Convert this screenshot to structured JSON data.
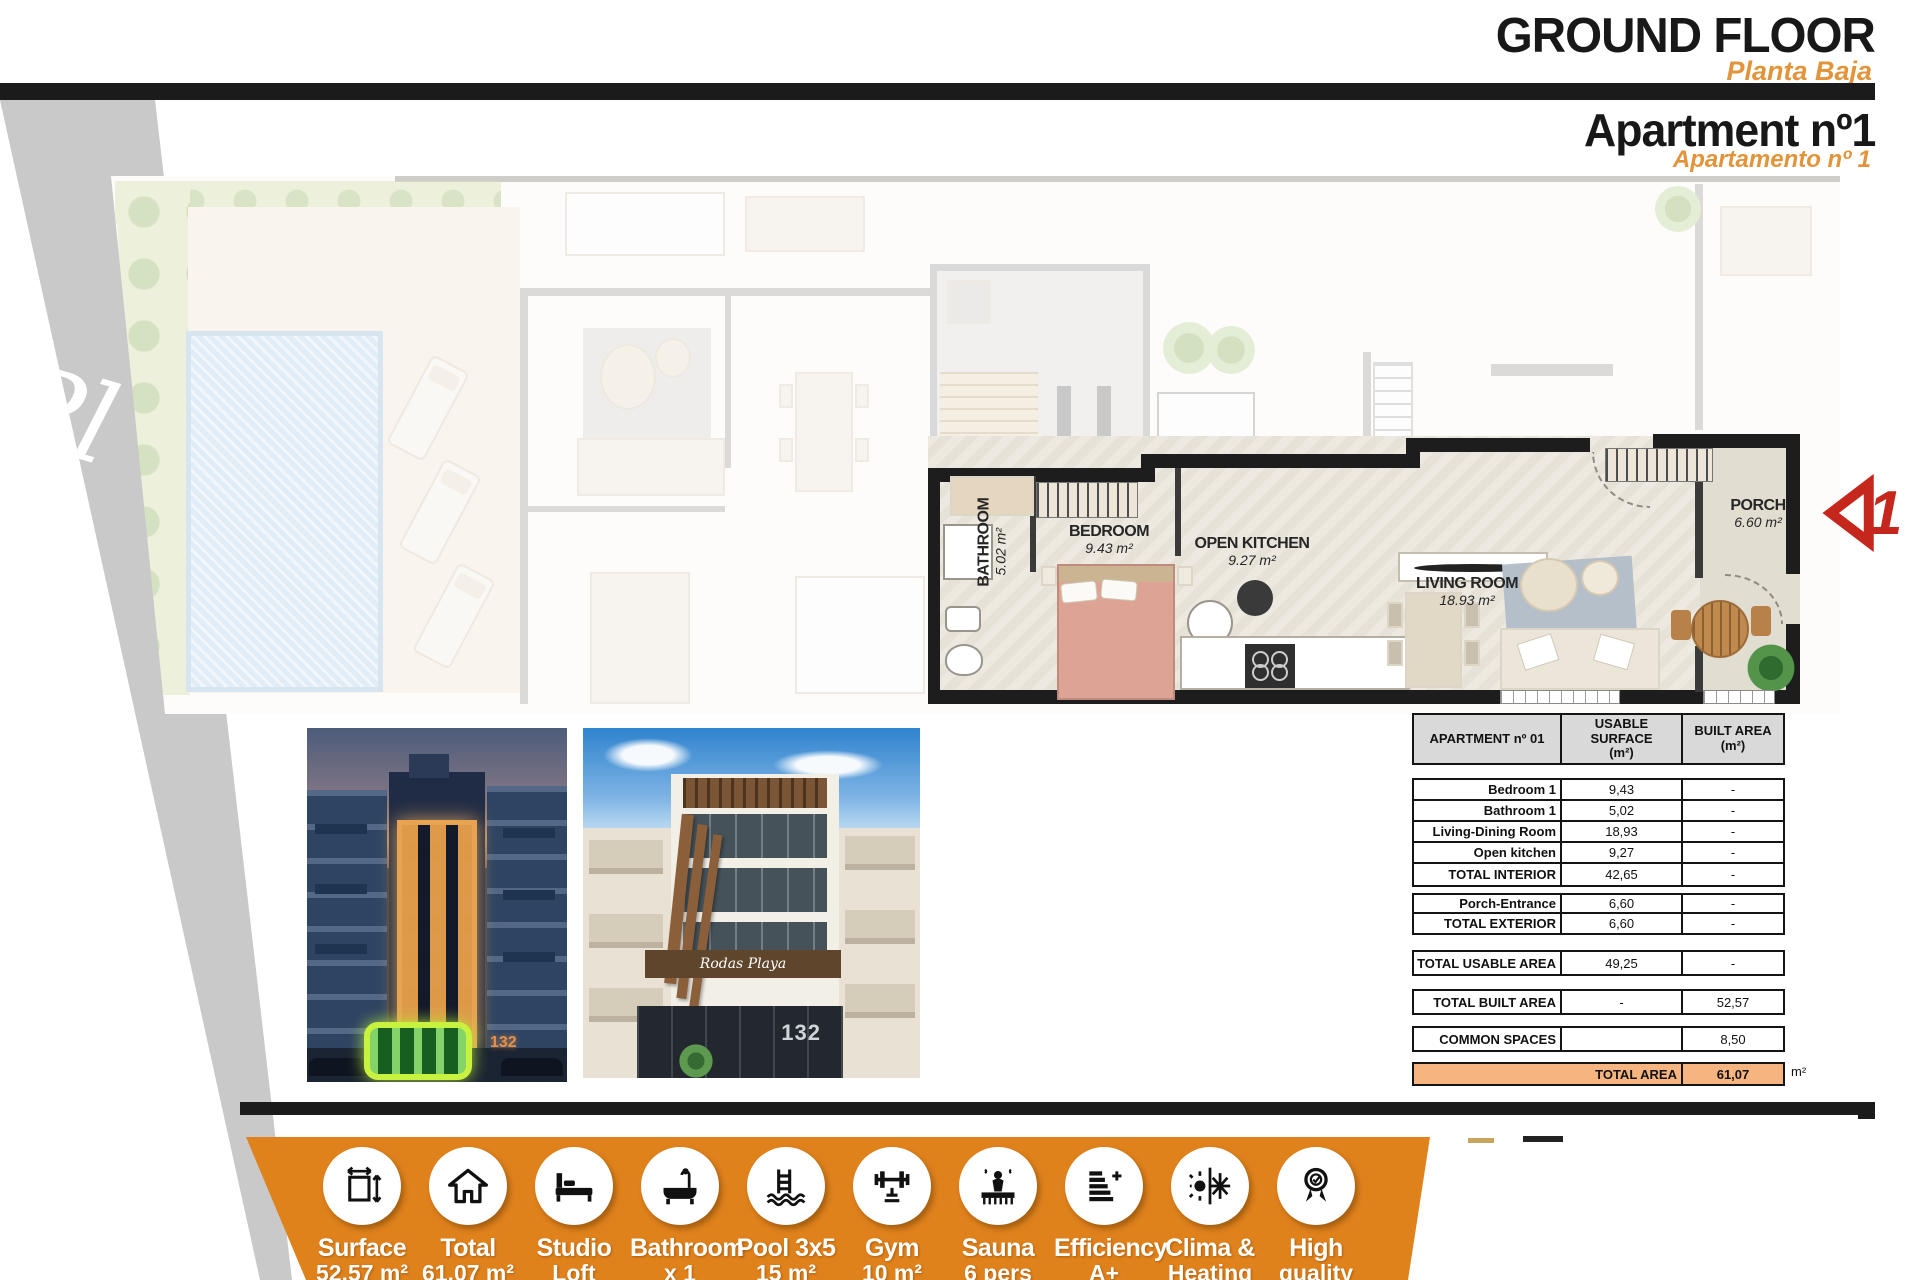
{
  "header": {
    "title": "GROUND FLOOR",
    "subtitle": "Planta Baja",
    "unit_title": "Apartment nº1",
    "unit_subtitle": "Apartamento nº 1"
  },
  "floorplan": {
    "watermark": "Pl",
    "marker": "1",
    "rooms": [
      {
        "id": "bathroom",
        "name": "BATHROOM",
        "area": "5.02 m²"
      },
      {
        "id": "bedroom",
        "name": "BEDROOM",
        "area": "9.43 m²"
      },
      {
        "id": "open-kitchen",
        "name": "OPEN KITCHEN",
        "area": "9.27 m²"
      },
      {
        "id": "living-room",
        "name": "LIVING ROOM",
        "area": "18.93 m²"
      },
      {
        "id": "porch",
        "name": "PORCH",
        "area": "6.60 m²"
      }
    ]
  },
  "photos": {
    "night_number": "132",
    "day_number": "132",
    "day_sign": "Rodas Playa"
  },
  "table": {
    "header": [
      "APARTMENT nº 01",
      "USABLE SURFACE\n(m²)",
      "BUILT AREA\n(m²)"
    ],
    "blocks": [
      {
        "rows": [
          [
            "Bedroom 1",
            "9,43",
            "-"
          ],
          [
            "Bathroom 1",
            "5,02",
            "-"
          ],
          [
            "Living-Dining Room",
            "18,93",
            "-"
          ],
          [
            "Open kitchen",
            "9,27",
            "-"
          ],
          [
            "TOTAL INTERIOR",
            "42,65",
            "-"
          ]
        ]
      },
      {
        "rows": [
          [
            "Porch-Entrance",
            "6,60",
            "-"
          ],
          [
            "TOTAL EXTERIOR",
            "6,60",
            "-"
          ]
        ]
      },
      {
        "rows": [
          [
            "TOTAL USABLE AREA",
            "49,25",
            "-"
          ]
        ]
      },
      {
        "rows": [
          [
            "TOTAL BUILT AREA",
            "-",
            "52,57"
          ]
        ]
      },
      {
        "rows": [
          [
            "COMMON SPACES",
            "",
            "8,50"
          ]
        ]
      }
    ],
    "total_row": {
      "label": "TOTAL AREA",
      "value": "61,07"
    },
    "unit_suffix": "m²"
  },
  "amenities": {
    "items": [
      {
        "icon": "surface-icon",
        "l1": "Surface",
        "l2": "52,57 m²"
      },
      {
        "icon": "house-icon",
        "l1": "Total",
        "l2": "61,07 m²"
      },
      {
        "icon": "bed-icon",
        "l1": "Studio",
        "l2": "Loft"
      },
      {
        "icon": "bathtub-icon",
        "l1": "Bathroom",
        "l2": "x 1"
      },
      {
        "icon": "pool-icon",
        "l1": "Pool 3x5",
        "l2": "15 m²"
      },
      {
        "icon": "gym-icon",
        "l1": "Gym",
        "l2": "10 m²"
      },
      {
        "icon": "sauna-icon",
        "l1": "Sauna",
        "l2": "6 pers"
      },
      {
        "icon": "efficiency-icon",
        "l1": "Efficiency",
        "l2": "A+"
      },
      {
        "icon": "clima-icon",
        "l1": "Clima &",
        "l2": "Heating"
      },
      {
        "icon": "quality-icon",
        "l1": "High",
        "l2": "quality"
      }
    ]
  },
  "colors": {
    "title_orange": "#E2943A",
    "bar_orange": "#E0821C",
    "table_total_bg": "#F5B480",
    "highlight_green": "#C9F13F",
    "marker_red": "#C6271C"
  }
}
